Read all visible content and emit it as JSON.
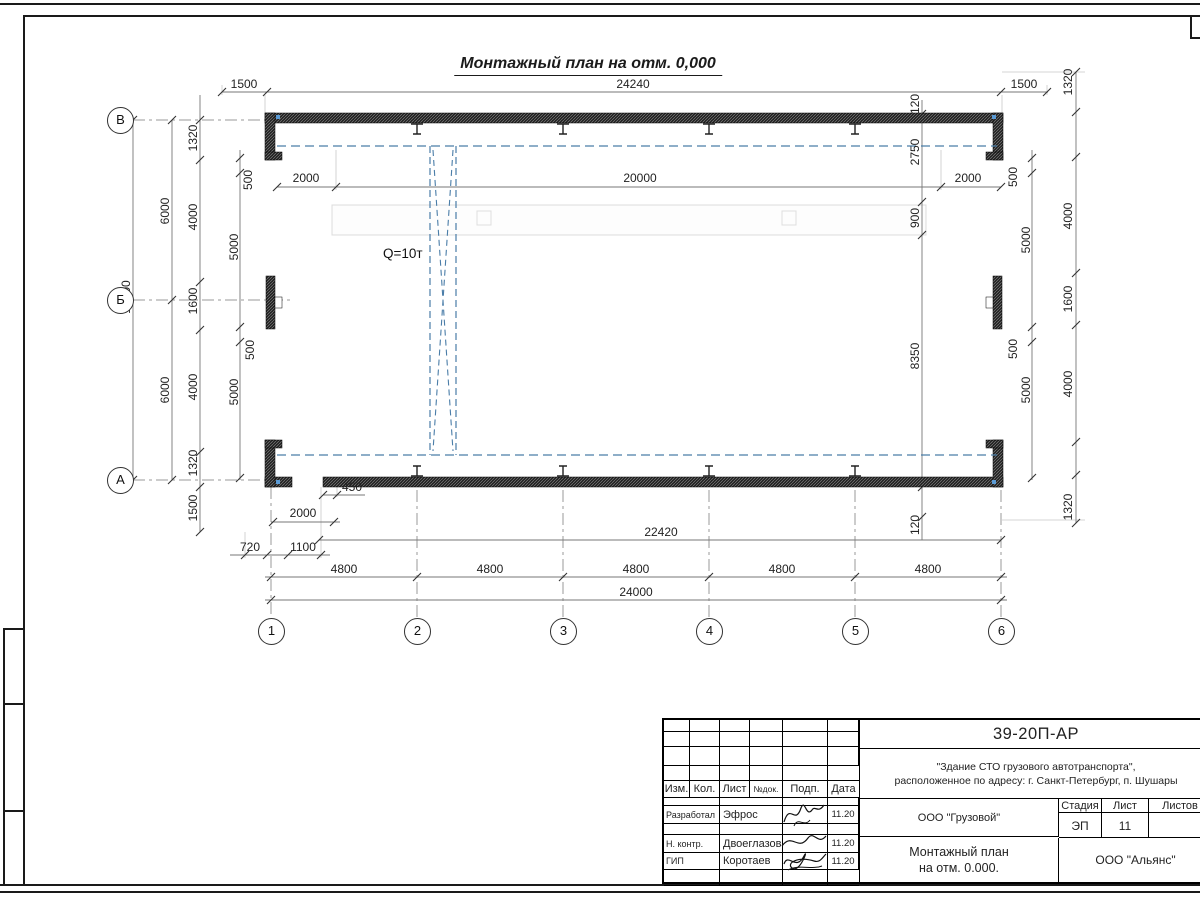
{
  "sheet": {
    "drawing_title": "Монтажный план на отм. 0,000",
    "crane_capacity": "Q=10т"
  },
  "grid": {
    "rows": [
      "В",
      "Б",
      "А"
    ],
    "cols": [
      "1",
      "2",
      "3",
      "4",
      "5",
      "6"
    ]
  },
  "dims": {
    "top_1500_l": "1500",
    "top_24240": "24240",
    "top_1500_r": "1500",
    "in_2000_l": "2000",
    "in_20000": "20000",
    "in_2000_r": "2000",
    "left_12000": "12000",
    "left_6000_a": "6000",
    "left_6000_b": "6000",
    "left_1320_t": "1320",
    "left_4000_t": "4000",
    "left_1600": "1600",
    "left_4000_b": "4000",
    "left_1320_b": "1320",
    "left_1500": "1500",
    "left_500_t": "500",
    "left_5000_t": "5000",
    "left_500_b": "500",
    "left_5000_b": "5000",
    "right_1320_t": "1320",
    "right_4000_t": "4000",
    "right_1600": "1600",
    "right_4000_b": "4000",
    "right_1320_b": "1320",
    "right_500_t": "500",
    "right_5000_t": "5000",
    "right_500_b": "500",
    "right_5000_b": "5000",
    "mid_120_t": "120",
    "mid_2750": "2750",
    "mid_900": "900",
    "mid_8350": "8350",
    "mid_120_b": "120",
    "bot_450": "450",
    "bot_2000": "2000",
    "bot_720": "720",
    "bot_1100": "1100",
    "bot_22420": "22420",
    "bot_24000": "24000",
    "bot_4800": [
      "4800",
      "4800",
      "4800",
      "4800",
      "4800"
    ]
  },
  "title_block": {
    "doc_code": "39-20П-АР",
    "project_line1": "\"Здание СТО грузового автотранспорта\",",
    "project_line2": "расположенное по адресу: г. Санкт-Петербург, п. Шушары",
    "header_cells": [
      "Изм.",
      "Кол.",
      "Лист",
      "№док.",
      "Подп.",
      "Дата"
    ],
    "rows": [
      {
        "role": "Разработал",
        "name": "Эфрос",
        "date": "11.20"
      },
      {
        "role": "Н. контр.",
        "name": "Двоеглазов",
        "date": "11.20"
      },
      {
        "role": "ГИП",
        "name": "Коротаев",
        "date": "11.20"
      }
    ],
    "org_cell": "ООО \"Грузовой\"",
    "sheet_title_line1": "Монтажный план",
    "sheet_title_line2": "на отм. 0.000.",
    "stage_label": "Стадия",
    "sheet_label": "Лист",
    "sheets_label": "Листов",
    "stage_value": "ЭП",
    "sheet_value": "11",
    "sheets_value": "",
    "company": "ООО \"Альянс\""
  }
}
